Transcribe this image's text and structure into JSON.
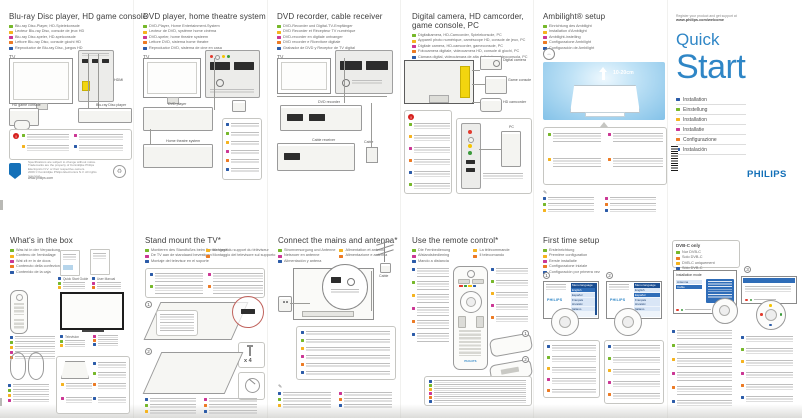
{
  "cover": {
    "register1": "Register your product and get support at",
    "register2": "www.philips.com/welcome",
    "quick": "Quick",
    "start": "Start",
    "languages": [
      {
        "color": "#2b5ba8",
        "label": "Installation"
      },
      {
        "color": "#76b82a",
        "label": "Einstellung"
      },
      {
        "color": "#f5b31e",
        "label": "Installation"
      },
      {
        "color": "#cb3694",
        "label": "Installatie"
      },
      {
        "color": "#ec7a23",
        "label": "Configurazione"
      },
      {
        "color": "#2b5ba8",
        "label": "Instalación"
      }
    ],
    "brand": "PHILIPS"
  },
  "top": {
    "bluray": {
      "title": "Blu-ray Disc player, HD game console",
      "tag": "TV",
      "translations": [
        {
          "color": "#76b82a",
          "label": "Blu-ray Disc-Player, HD-Spielekonsole"
        },
        {
          "color": "#f5b31e",
          "label": "Lecteur Blu-ray Disc, console de jeux HD"
        },
        {
          "color": "#cb3694",
          "label": "Blu-ray Disc-speler, HD-spelconsole"
        },
        {
          "color": "#ec7a23",
          "label": "Lettore Blu-ray Disc, console giochi HD"
        },
        {
          "color": "#2b5ba8",
          "label": "Reproductor de Blu-ray Disc, juegos HD"
        }
      ],
      "labels": {
        "hdmi": "HDMI",
        "player": "Blu-ray Disc player",
        "console": "HD game console"
      },
      "footer": {
        "legal1": "Specifications are subject to change without notice.",
        "legal2": "Trademarks are the property of Koninklijke Philips Electronics N.V. or their respective owners.",
        "legal3": "2009 © Koninklijke Philips Electronics N.V. All rights reserved.",
        "site": "www.philips.com"
      }
    },
    "dvd": {
      "title": "DVD player, home theatre system",
      "tag": "TV",
      "translations": [
        {
          "color": "#76b82a",
          "label": "DVD-Player, Home Entertainment-System"
        },
        {
          "color": "#f5b31e",
          "label": "Lecteur de DVD, système home cinéma"
        },
        {
          "color": "#cb3694",
          "label": "DVD-speler, home theatre systeem"
        },
        {
          "color": "#ec7a23",
          "label": "Lettore DVD, sistema home theatre"
        },
        {
          "color": "#2b5ba8",
          "label": "Reproductor DVD, sistema de cine en casa"
        }
      ],
      "labels": {
        "player": "DVD player",
        "hts": "Home theatre system"
      }
    },
    "recorder": {
      "title": "DVD recorder, cable receiver",
      "tag": "TV",
      "translations": [
        {
          "color": "#76b82a",
          "label": "DVD-Recorder und Digital-TV-Empfänger"
        },
        {
          "color": "#f5b31e",
          "label": "DVD Recorder et Récepteur TV numérique"
        },
        {
          "color": "#cb3694",
          "label": "DVD-recorder en digitale ontvanger"
        },
        {
          "color": "#ec7a23",
          "label": "DVD recorder e Ricevitore digitale"
        },
        {
          "color": "#2b5ba8",
          "label": "Grabador de DVD y Receptor de TV digital"
        }
      ],
      "labels": {
        "recorder": "DVD recorder",
        "receiver": "Cable receiver",
        "cable": "Cable"
      }
    },
    "camera": {
      "title1": "Digital camera, HD camcorder,",
      "title2": "game console, PC",
      "translations": [
        {
          "color": "#76b82a",
          "label": "Digitalkamera, HD-Camcorder, Spielekonsole, PC"
        },
        {
          "color": "#f5b31e",
          "label": "Appareil photo numérique, caméscope HD, console de jeux, PC"
        },
        {
          "color": "#cb3694",
          "label": "Digitale camera, HD-camcorder, gameconsole, PC"
        },
        {
          "color": "#ec7a23",
          "label": "Fotocamera digitale, videocamera HD, console di giochi, PC"
        },
        {
          "color": "#2b5ba8",
          "label": "Cámara digital, videocámara de alta definición, videoconsola, PC"
        }
      ],
      "labels": {
        "camera": "Digital camera",
        "console": "Game console",
        "camcorder": "HD camcorder",
        "pc": "PC"
      }
    },
    "ambilight": {
      "title": "Ambilight® setup",
      "distance": "10-20cm",
      "translations": [
        {
          "color": "#76b82a",
          "label": "Einrichtung des Ambilight"
        },
        {
          "color": "#f5b31e",
          "label": "Installation d'Ambilight"
        },
        {
          "color": "#cb3694",
          "label": "Ambilight-instelling"
        },
        {
          "color": "#ec7a23",
          "label": "Configurazione Ambilight"
        },
        {
          "color": "#2b5ba8",
          "label": "Configuración de Ambilight"
        }
      ]
    }
  },
  "bottom": {
    "box": {
      "title": "What's in the box",
      "translations": [
        {
          "color": "#76b82a",
          "label": "Was ist in der Verpackung"
        },
        {
          "color": "#f5b31e",
          "label": "Contenu de l'emballage"
        },
        {
          "color": "#cb3694",
          "label": "Wat zit er in de doos"
        },
        {
          "color": "#ec7a23",
          "label": "Contenuto della confezione"
        },
        {
          "color": "#2b5ba8",
          "label": "Contenido de la caja"
        }
      ],
      "labels": {
        "qsg": "Quick Start Guide",
        "manual": "User Manual",
        "tv": "Television"
      }
    },
    "stand": {
      "title": "Stand mount the TV*",
      "step1": "1",
      "step2": "2",
      "screws": "x 4",
      "translations": [
        {
          "color": "#76b82a",
          "label": "Montieren des Standfußes beim Fernsehgerät"
        },
        {
          "color": "#f5b31e",
          "label": "Montage du support du téléviseur"
        },
        {
          "color": "#cb3694",
          "label": "De TV aan de standaard bevestigen"
        },
        {
          "color": "#ec7a23",
          "label": "Montaggio del televisore sul supporto"
        },
        {
          "color": "#2b5ba8",
          "label": "Montaje del televisor en el soporte"
        }
      ]
    },
    "mains": {
      "title": "Connect the mains and antenna*",
      "cable": "Cable",
      "translations": [
        {
          "color": "#76b82a",
          "label": "Stromversorgung und Antenne"
        },
        {
          "color": "#f5b31e",
          "label": "Alimentation et antenne"
        },
        {
          "color": "#cb3694",
          "label": "Netsnoer en antenne"
        },
        {
          "color": "#ec7a23",
          "label": "Alimentazione e antenna"
        },
        {
          "color": "#2b5ba8",
          "label": "Alimentación y antena"
        }
      ]
    },
    "remote": {
      "title": "Use the remote control*",
      "brand": "PHILIPS",
      "step1": "1",
      "step2": "2",
      "translations": [
        {
          "color": "#76b82a",
          "label": "Die Fernbedienung"
        },
        {
          "color": "#f5b31e",
          "label": "La télécommande"
        },
        {
          "color": "#cb3694",
          "label": "Afstandsbediening"
        },
        {
          "color": "#ec7a23",
          "label": "Il telecomando"
        },
        {
          "color": "#2b5ba8",
          "label": "Mando a distancia"
        }
      ]
    },
    "setup": {
      "title": "First time setup",
      "step1": "1",
      "step2": "2",
      "screen_title": "Menu language",
      "brand": "PHILIPS",
      "menu_langs": [
        "English",
        "Español",
        "Français",
        "Hrvatski",
        "Italiano"
      ],
      "translations": [
        {
          "color": "#76b82a",
          "label": "Ersteinrichtung"
        },
        {
          "color": "#f5b31e",
          "label": "Première configuration"
        },
        {
          "color": "#cb3694",
          "label": "Eerste installatie"
        },
        {
          "color": "#ec7a23",
          "label": "Configurazione iniziale"
        },
        {
          "color": "#2b5ba8",
          "label": "Configuración por primera vez"
        }
      ]
    },
    "setup2": {
      "dvbc_title": "DVB-C only",
      "step3": "3",
      "screen_title": "Installation mode",
      "opt1": "Antenna",
      "opt2": "Cable",
      "dvbc": [
        {
          "color": "#76b82a",
          "label": "Nur DVB-C"
        },
        {
          "color": "#ec7a23",
          "label": "Solo DVB-C"
        },
        {
          "color": "#f5b31e",
          "label": "DVB-C uniquement"
        },
        {
          "color": "#2b5ba8",
          "label": "Sólo DVB-C"
        },
        {
          "color": "#cb3694",
          "label": "Alleen DVB-C"
        }
      ]
    }
  }
}
